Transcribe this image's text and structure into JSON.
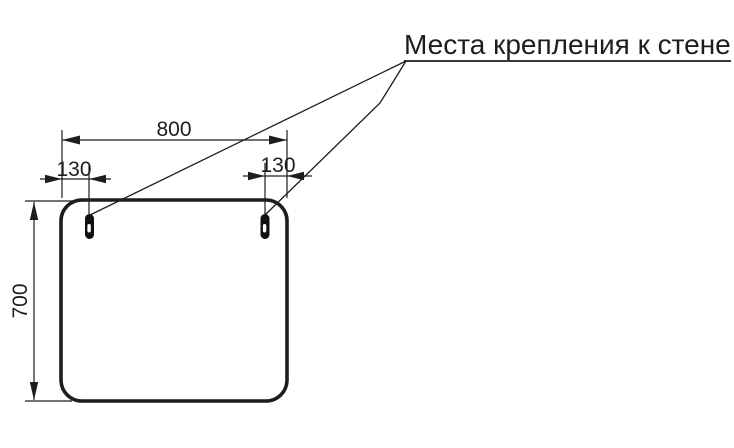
{
  "drawing": {
    "callout": {
      "text": "Места крепления к стене"
    },
    "dimensions": {
      "overall_width": "800",
      "left_hole_offset": "130",
      "right_hole_offset": "130",
      "overall_height": "700"
    },
    "units_note": "",
    "colors": {
      "line": "#1d1d1d",
      "background": "#ffffff",
      "slot_fill": "#111111"
    }
  }
}
